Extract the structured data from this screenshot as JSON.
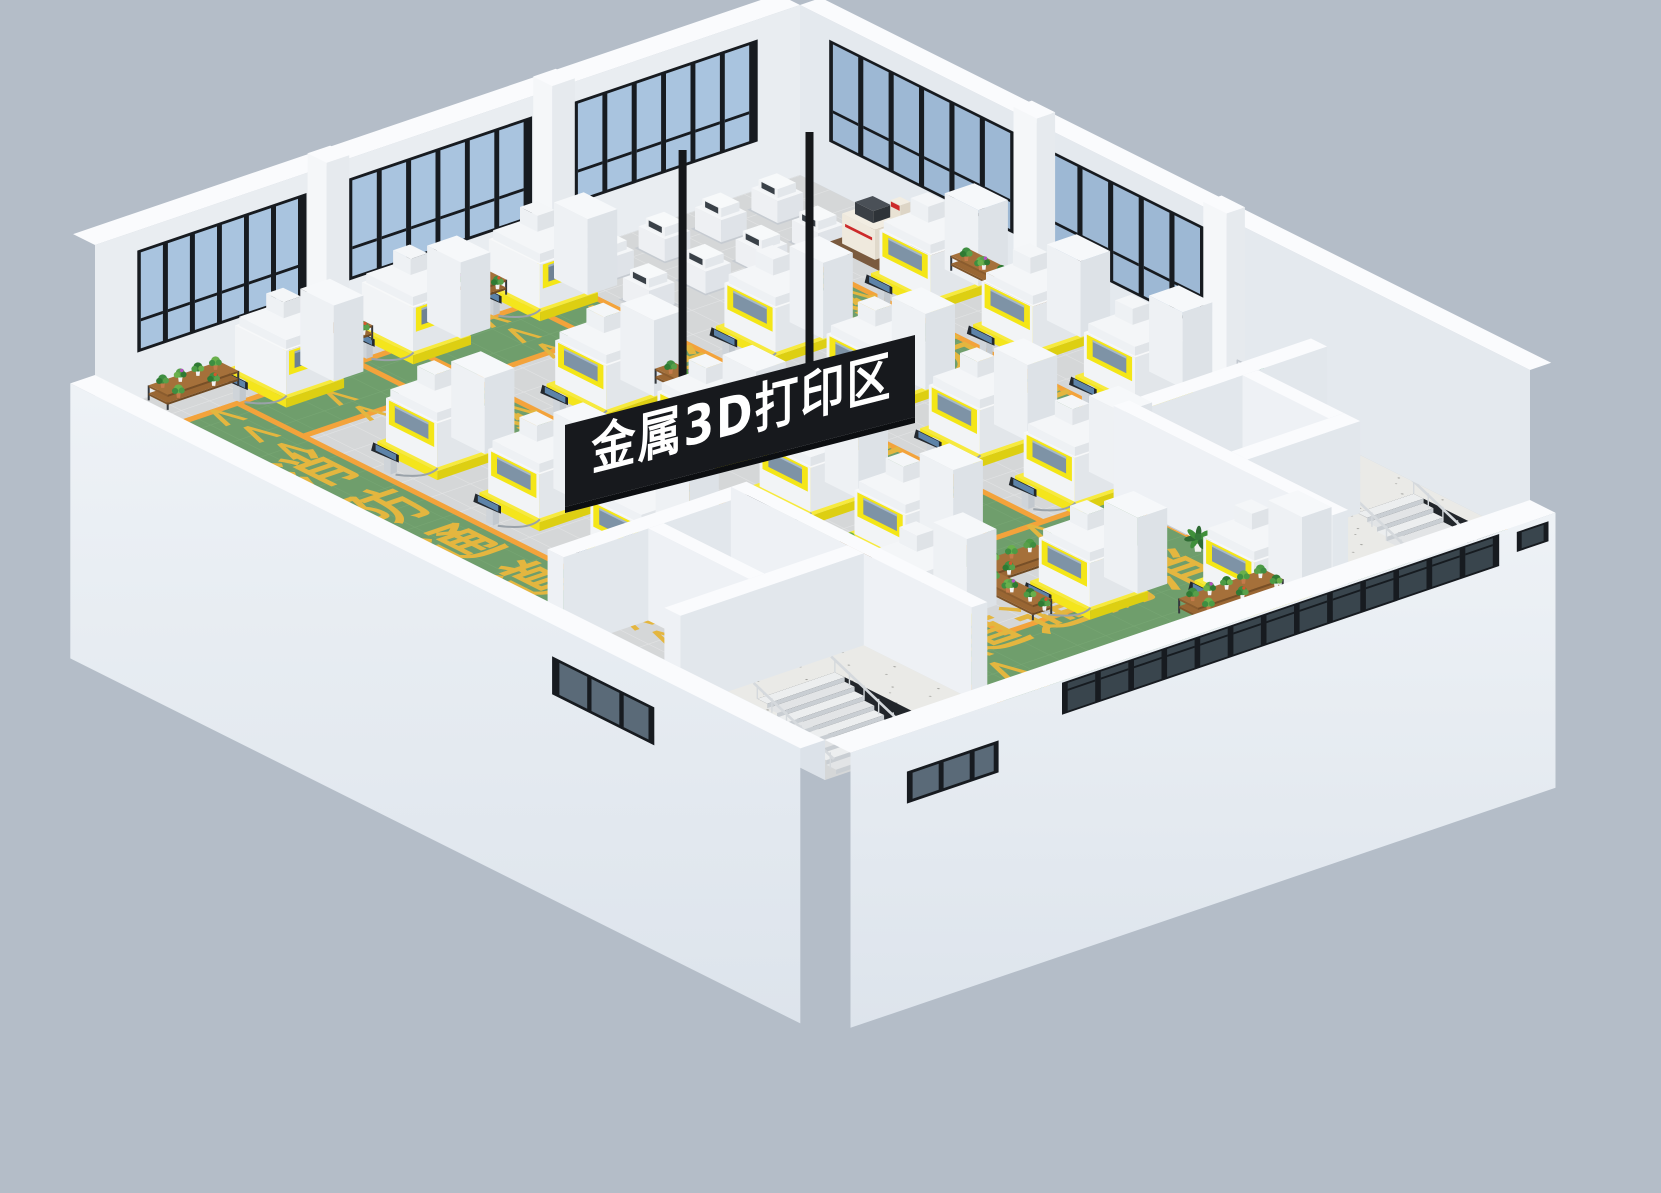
{
  "scene": {
    "description": "isometric 3D render of a metal 3D printing factory hall",
    "area_sign": {
      "text": "金属3D打印区",
      "bg_color": "#17191d",
      "text_color": "#ffffff"
    },
    "floor_markings": {
      "lane_label": "消防通道",
      "lane_chars": [
        "消",
        "防",
        "通",
        "道"
      ],
      "chevron": "<<<",
      "marking_color": "#e4b63f",
      "aisle_color": "#6f9e6c",
      "aisle_border_color": "#f3a33b"
    },
    "equipment": {
      "metal_3d_printers": 20,
      "filter_towers": 20,
      "control_monitors": 20,
      "small_finishing_machines": 8,
      "measuring_machines": 1,
      "plant_racks": 13,
      "potted_palms": 3,
      "staircases": 2
    },
    "colors": {
      "background": "#b4bdc8",
      "wall_white": "#f2f4f7",
      "wall_inner": "#e9edf1",
      "wall_top": "#fafbfd",
      "floor_tile": "#d5d7d8",
      "tile_grout": "#e2e3e4",
      "concrete": "#eaeae7",
      "glass_blue": "#a9c4df",
      "frame_dark": "#171b20",
      "machine_yellow": "#f4e617",
      "machine_white": "#f2f4f6",
      "machine_window": "#7e93a6",
      "rack_wood": "#996633",
      "rack_frame": "#34383d",
      "plant_green": "#3e8e41",
      "exit_green": "#27a85a",
      "stair_dark": "#22262b",
      "railing": "#d5d9dd"
    }
  }
}
